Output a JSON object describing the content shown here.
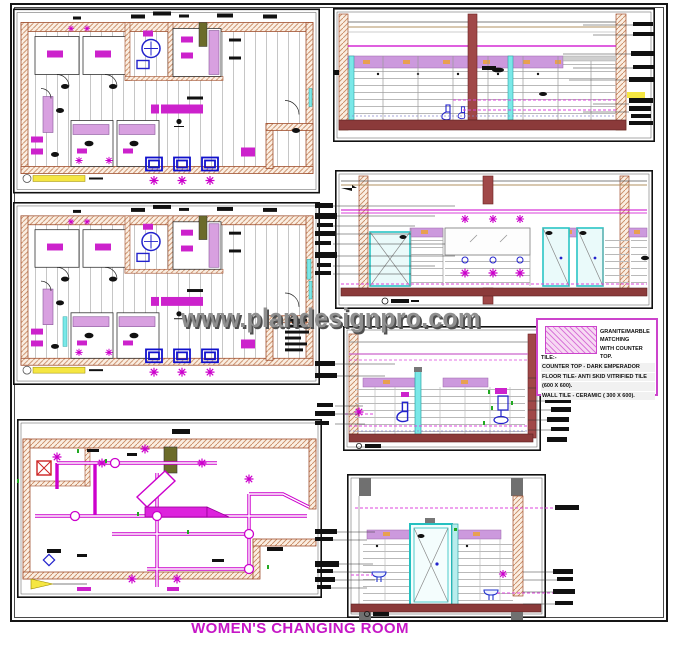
{
  "sheet": {
    "watermark": "www.plandesignpro.com",
    "title": "WOMEN'S CHANGING ROOM"
  },
  "legend": {
    "swatch_name": "granite-marble-hatch",
    "swatch_label_line1": "GRANITE/MARBLE MATCHING",
    "swatch_label_line2": "WITH COUNTER TOP.",
    "tile_heading": "TILE:-",
    "lines": [
      "COUNTER TOP - DARK EMPERADOR",
      "FLOOR TILE- ANTI SKID VITRIFIED TILE",
      "(600 X 600).",
      "WALL TILE - CERAMIC ( 300 X 600)."
    ]
  },
  "colors": {
    "accent_magenta": "#cc00cc",
    "title_magenta": "#c617c6",
    "wall_hatch": "#c98a62",
    "floor_brown": "#8b3a3a",
    "fixture_blue": "#2222cc",
    "door_cyan": "#29c5c5",
    "band_purple": "#cc99dd",
    "scale_yellow": "#f5e642",
    "watermark_gray": "#8f8f8f"
  }
}
